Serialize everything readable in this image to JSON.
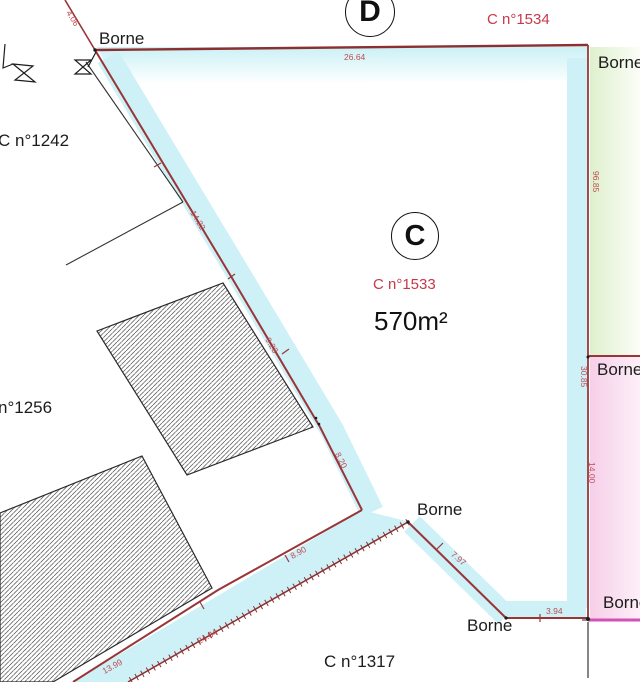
{
  "plan": {
    "type": "cadastral-survey-plan",
    "parcel_c": {
      "circle_letter": "C",
      "number": "C n°1533",
      "area": "570m²"
    },
    "parcel_d": {
      "circle_letter": "D",
      "number": "C n°1534"
    },
    "neighbors": {
      "c1242": "C n°1242",
      "n1256": "n°1256",
      "c1317": "C n°1317"
    },
    "bornes": {
      "top_left": "Borne",
      "top_right": "Borne",
      "mid_right": "Borne",
      "center": "Borne",
      "bottom": "Borne",
      "bottom_right": "Borne"
    },
    "dims": {
      "d_4_06": "4.06",
      "d_26_64": "26.64",
      "d_96_85": "96.85",
      "d_14_22": "14.22",
      "d_9_23": "9.23",
      "d_8_20": "8.20",
      "d_30_85": "30.85",
      "d_14_00": "14.00",
      "d_7_97": "7.97",
      "d_8_90": "8.90",
      "d_24_84": "24.84",
      "d_13_99": "13.99",
      "d_3_94": "3.94"
    }
  },
  "colors": {
    "boundary_red": "#9a3537",
    "dimension_red": "#bf4a52",
    "parcel_label_red": "#c43a4a",
    "highlight_cyan": "#cdf1f6",
    "highlight_green": "#dff0cd",
    "highlight_pink": "#f6cfe8",
    "magenta_line": "#d44fb8",
    "text_black": "#1c1c1c"
  }
}
